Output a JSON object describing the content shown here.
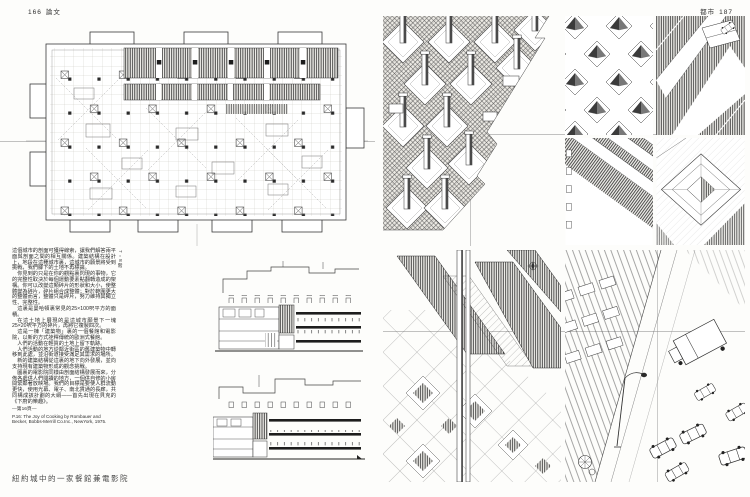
{
  "left_page": {
    "header": {
      "page_number": "166",
      "section": "論文"
    },
    "plan_floor_label": "7・8階",
    "body_paragraphs": [
      "這個城市的剖面可獲得線索，讓我們解答兩平面與剖面之間的相互關係。建築結構在設計上，地段在這種城市裏，這城市的願景將受到挑戰，我們腳下的土地不再標識。",
      "你見到的只是在你的觀點裏閃現的事物，它的完整性取決於每個運動要素點翻轉造成的架構。你可以改變這類碎片的形狀和大小，使整體變為碎片，碎片組合成整體；對於範圍更大的整體而言，整體只是碎片，努力維持其獨立性、完整性。",
      "這裏是曼哈頓裏常見的25×100呎平方的面積。",
      "在這土地上展現的是這城市願景下一塊25×20呎平方的碎片，再將它複製四次。",
      "這是一棟「建築物」裏的一個餐館和電影院，以新的方式詮釋傳統的歐洲式餐館。",
      "人們的活動在輕質的土地上留下軌跡。",
      "人們活動的地方從鄰近街區的舊建築物中轉移到此處，並沿街道接受滿足其需求的場所。",
      "新的建築結構從這裏的地下向外發展，並向支持現有建築物形成的觀念挑戰。",
      "圖裏的電影院同樣由剖面結構發展而來，分佈各處供人們閱讀的地方，一個供自修的小房間緊鄰著放映場。我們的目標是要使人群流動更快，使用光幕、電子、南北貫通的長廊，共同構成該計劃的大綱——首先出現在貝克的《下廚的樂趣》。"
    ],
    "page_ref_note": "—第16頁—",
    "caption_en": {
      "line1": "P.16: The Joy of Cooking by Rombauer and",
      "line2": "Becker, Bobbs-Merrill Co.Inc., NewYork, 1975."
    },
    "figure_title": "紐約城中的一家餐館兼電影院"
  },
  "right_page": {
    "header": {
      "section": "都市",
      "page_number": "187"
    }
  },
  "colors": {
    "ink": "#1f1f1f",
    "paper": "#fdfdfb",
    "register_line": "#8f8f8f"
  }
}
